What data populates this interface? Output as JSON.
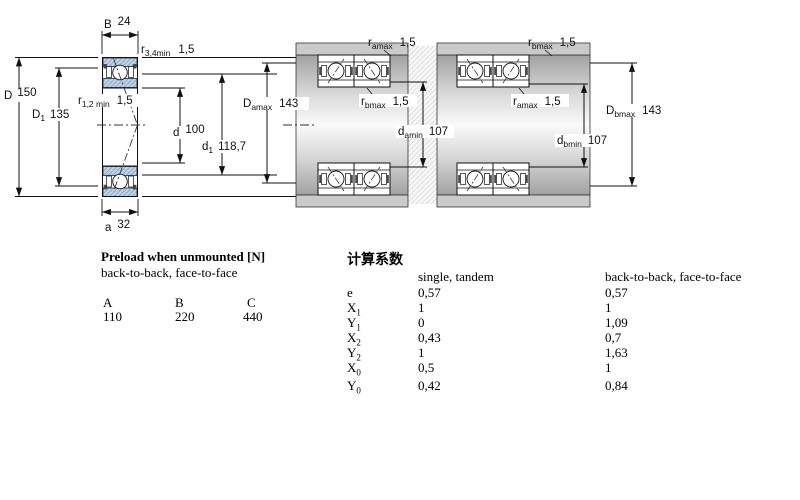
{
  "dims": {
    "single": {
      "B": {
        "sym": "B",
        "sub": "",
        "val": "24"
      },
      "r34": {
        "sym": "r",
        "sub": "3,4min",
        "val": "1,5"
      },
      "D": {
        "sym": "D",
        "sub": "",
        "val": "150"
      },
      "D1": {
        "sym": "D",
        "sub": "1",
        "val": "135"
      },
      "r12": {
        "sym": "r",
        "sub": "1,2 min",
        "val": "1,5"
      },
      "d": {
        "sym": "d",
        "sub": "",
        "val": "100"
      },
      "d1": {
        "sym": "d",
        "sub": "1",
        "val": "118,7"
      },
      "a": {
        "sym": "a",
        "sub": "",
        "val": "32"
      }
    },
    "btb": {
      "ra": {
        "sym": "r",
        "sub": "amax",
        "val": "1,5"
      },
      "Da": {
        "sym": "D",
        "sub": "amax",
        "val": "143"
      },
      "rb": {
        "sym": "r",
        "sub": "bmax",
        "val": "1,5"
      },
      "da": {
        "sym": "d",
        "sub": "amin",
        "val": "107"
      }
    },
    "ftf": {
      "rb": {
        "sym": "r",
        "sub": "bmax",
        "val": "1,5"
      },
      "ra": {
        "sym": "r",
        "sub": "amax",
        "val": "1,5"
      },
      "db": {
        "sym": "d",
        "sub": "bmin",
        "val": "107"
      },
      "Db": {
        "sym": "D",
        "sub": "bmax",
        "val": "143"
      }
    }
  },
  "preload": {
    "title": "Preload when unmounted [N]",
    "subtitle": "back-to-back, face-to-face",
    "headers": [
      "A",
      "B",
      "C"
    ],
    "values": [
      "110",
      "220",
      "440"
    ]
  },
  "factors": {
    "title": "计算系数",
    "col_single": "single, tandem",
    "col_pair": "back-to-back, face-to-face",
    "rows": [
      {
        "sym": "e",
        "sub": "",
        "single": "0,57",
        "pair": "0,57"
      },
      {
        "sym": "X",
        "sub": "1",
        "single": "1",
        "pair": "1"
      },
      {
        "sym": "Y",
        "sub": "1",
        "single": "0",
        "pair": "1,09"
      },
      {
        "sym": "X",
        "sub": "2",
        "single": "0,43",
        "pair": "0,7"
      },
      {
        "sym": "Y",
        "sub": "2",
        "single": "1",
        "pair": "1,63"
      },
      {
        "sym": "X",
        "sub": "0",
        "single": "0,5",
        "pair": "1"
      },
      {
        "sym": "Y",
        "sub": "0",
        "single": "0,42",
        "pair": "0,84"
      }
    ]
  },
  "colors": {
    "ring_blue": "#bdd2e6",
    "ring_hatch_line": "#87a3bf",
    "housing_gray": "#cacaca",
    "shaft_dark": "#a2a2a2",
    "shaft_light": "#fafafa",
    "line": "#111111"
  }
}
